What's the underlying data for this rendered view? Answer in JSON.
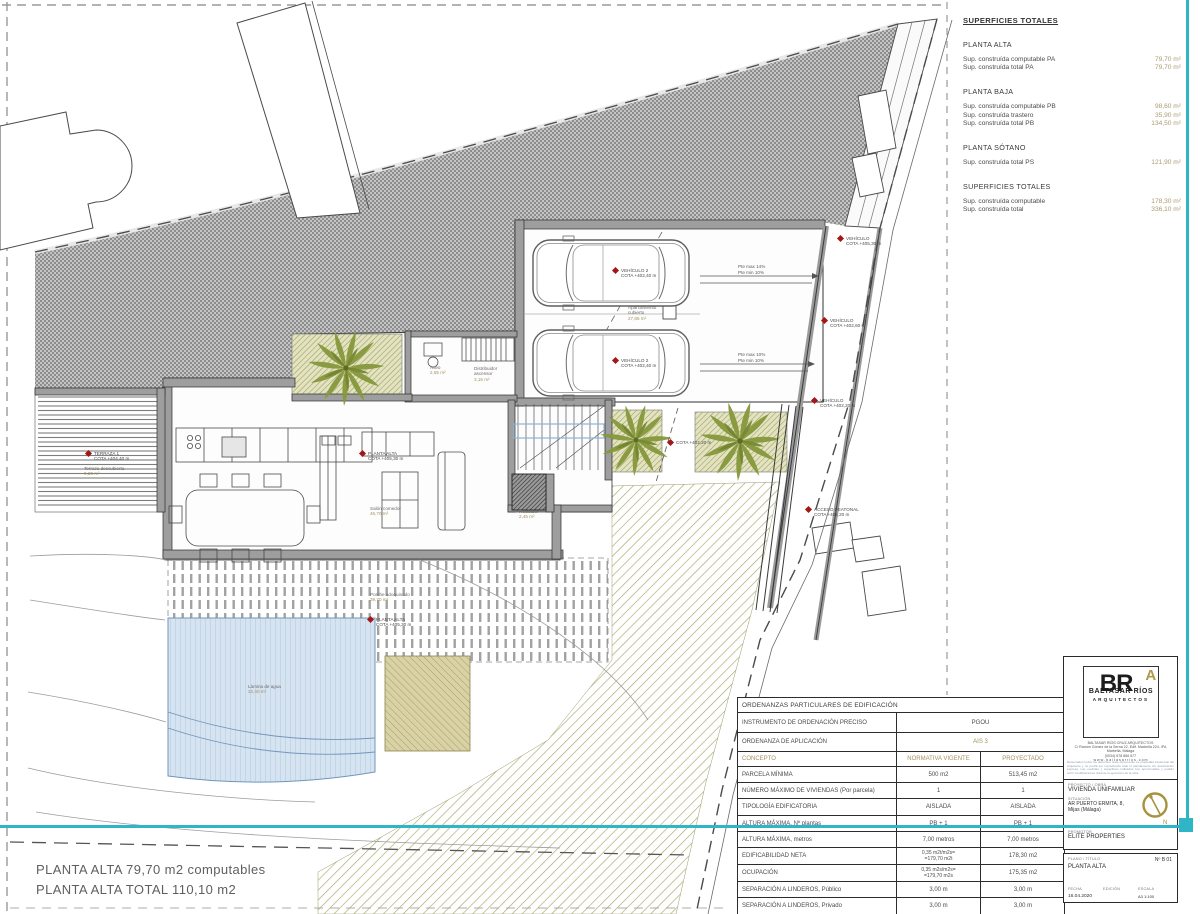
{
  "superficies": {
    "title": "SUPERFICIES TOTALES",
    "sections": [
      {
        "heading": "PLANTA ALTA",
        "rows": [
          [
            "Sup. construída computable PA",
            "79,70 m²"
          ],
          [
            "Sup. construída total PA",
            "79,70 m²"
          ]
        ]
      },
      {
        "heading": "PLANTA BAJA",
        "rows": [
          [
            "Sup. construída computable PB",
            "98,60 m²"
          ],
          [
            "Sup. construída trastero",
            "35,90 m²"
          ],
          [
            "Sup. construída total PB",
            "134,50 m²"
          ]
        ]
      },
      {
        "heading": "PLANTA SÓTANO",
        "rows": [
          [
            "Sup. construída total PS",
            "121,90 m²"
          ]
        ]
      },
      {
        "heading": "SUPERFICIES TOTALES",
        "rows": [
          [
            "Sup. construída computable",
            "178,30 m²"
          ],
          [
            "Sup. construída total",
            "336,10 m²"
          ]
        ]
      }
    ]
  },
  "ordenanzas": {
    "title": "ORDENANZAS PARTICULARES DE EDIFICACIÓN",
    "pre_rows": [
      {
        "label": "INSTRUMENTO DE ORDENACIÓN PRECISO",
        "value": "PGOU",
        "tan": false
      },
      {
        "label": "ORDENANZA DE APLICACIÓN",
        "value": "AIS 3",
        "tan": true
      }
    ],
    "header": [
      "CONCEPTO",
      "NORMATIVA VIGENTE",
      "PROYECTADO"
    ],
    "rows": [
      {
        "concepto": "PARCELA MÍNIMA",
        "vigente": "500 m2",
        "proyectado": "513,45 m2"
      },
      {
        "concepto": "NÚMERO MÁXIMO DE VIVIENDAS (Por parcela)",
        "vigente": "1",
        "proyectado": "1"
      },
      {
        "concepto": "TIPOLOGÍA EDIFICATORIA",
        "vigente": "AISLADA",
        "proyectado": "AISLADA"
      },
      {
        "concepto": "ALTURA MÁXIMA, Nº plantas",
        "vigente": "PB + 1",
        "proyectado": "PB + 1"
      },
      {
        "concepto": "ALTURA MÁXIMA, metros",
        "vigente": "7,00 metros",
        "proyectado": "7,00 metros"
      },
      {
        "concepto": "EDIFICABILIDAD NETA",
        "vigente": "0,35 m2t/m2s=\n=179,70 m2t",
        "proyectado": "178,30 m2"
      },
      {
        "concepto": "OCUPACIÓN",
        "vigente": "0,35 m2s/m2s=\n=179,70 m2s",
        "proyectado": "175,35 m2"
      },
      {
        "concepto": "SEPARACIÓN A LINDEROS, Público",
        "vigente": "3,00 m",
        "proyectado": "3,00 m"
      },
      {
        "concepto": "SEPARACIÓN A LINDEROS, Privado",
        "vigente": "3,00 m",
        "proyectado": "3,00 m"
      }
    ]
  },
  "titleblock": {
    "logo_br": "BR",
    "logo_a": "A",
    "firm_name": "BALTASAR RÍOS",
    "firm_sub": "ARQUITECTOS",
    "address_lines": [
      "BALTASAR RÍOS CRUZ   ARQUITECTOS",
      "C/ Ramón Gómez de la Serna 22, Edif. Marbella 224, 4ºA",
      "Marbella, Málaga",
      "(0034) 678 866 677",
      "w w w . b a l t a s a r r i o s . c o m"
    ],
    "disclaimer": "Reservados todos los derechos. Este documento es propiedad intelectual del arquitecto y no podrá ser reproducido total ni parcialmente sin autorización expresa. Las medidas y superficies indicadas son aproximadas y podrán sufrir modificaciones durante la ejecución de la obra.",
    "proyecto_label": "PROYECTO / OBRA",
    "proyecto": "VIVIENDA UNIFAMILIAR",
    "situacion_label": "SITUACIÓN",
    "situacion1": "AR PUERTO ERMITA, 8,",
    "situacion2": "Mijas (Málaga)",
    "promotor_label": "PROMOTOR",
    "promotor": "ELITE PROPERTIES",
    "plano_label": "PLANO / TÍTULO",
    "plano": "PLANTA ALTA",
    "num": "Nº  B 01",
    "fecha_label": "FECHA",
    "fecha": "16.04.2020",
    "edicion_label": "EDICIÓN",
    "edicion": "",
    "escala_label": "ESCALA",
    "escala": "A3  1:100",
    "north_letter": "N"
  },
  "footer": {
    "line1": "PLANTA ALTA 79,70 m2 computables",
    "line2": "PLANTA ALTA TOTAL  110,10 m2"
  },
  "plan": {
    "cota_markers": [
      {
        "x": 613,
        "y": 268,
        "text": "VEHÍCULO 2\nCOTA +402,40 m"
      },
      {
        "x": 613,
        "y": 358,
        "text": "VEHÍCULO 2\nCOTA +402,40 m"
      },
      {
        "x": 838,
        "y": 236,
        "text": "VEHÍCULO\nCOTA +405,30 m"
      },
      {
        "x": 822,
        "y": 318,
        "text": "VEHÍCULO\nCOTA +402,60 m"
      },
      {
        "x": 812,
        "y": 398,
        "text": "VEHÍCULO\nCOTA +402,20 m"
      },
      {
        "x": 668,
        "y": 440,
        "text": "COTA +402,20 m"
      },
      {
        "x": 806,
        "y": 507,
        "text": "ACCESO PEATONAL\nCOTA +401,20 m"
      },
      {
        "x": 86,
        "y": 451,
        "text": "TERRAZA 1\nCOTA +404,40 m"
      },
      {
        "x": 360,
        "y": 451,
        "text": "PLANTA ALTA\nCOTA +405,30 m"
      },
      {
        "x": 368,
        "y": 617,
        "text": "PLANTA ALTA\nCOTA +405,30 m"
      }
    ],
    "area_labels": [
      {
        "x": 628,
        "y": 305,
        "name": "Aparcamiento\ncubierto",
        "value": "27,85 m²"
      },
      {
        "x": 430,
        "y": 365,
        "name": "Aseo",
        "value": "2,65 m²"
      },
      {
        "x": 474,
        "y": 366,
        "name": "Distribuidor\nascensor",
        "value": "3,15 m²"
      },
      {
        "x": 519,
        "y": 509,
        "name": "Recibidor",
        "value": "2,45 m²"
      },
      {
        "x": 370,
        "y": 506,
        "name": "Salón comedor",
        "value": "46,70 m²"
      },
      {
        "x": 84,
        "y": 466,
        "name": "Terraza descubierta",
        "value": "9,20 m²"
      },
      {
        "x": 370,
        "y": 592,
        "name": "Porche adoquinado",
        "value": "39,70 m²"
      },
      {
        "x": 248,
        "y": 684,
        "name": "Lámina de agua",
        "value": "32,40 m²"
      }
    ],
    "ramp_labels": [
      {
        "x": 738,
        "y": 264,
        "text": "Pte max 14%\nPte min 10%"
      },
      {
        "x": 738,
        "y": 352,
        "text": "Pte max 10%\nPte min 10%"
      }
    ]
  },
  "colors": {
    "teal": "#2eb5c6",
    "tan": "#ab9b70",
    "red_marker": "#a31717",
    "olive": "#a8a868",
    "pool": "#d6e4f2",
    "gold": "#b09a4a"
  }
}
